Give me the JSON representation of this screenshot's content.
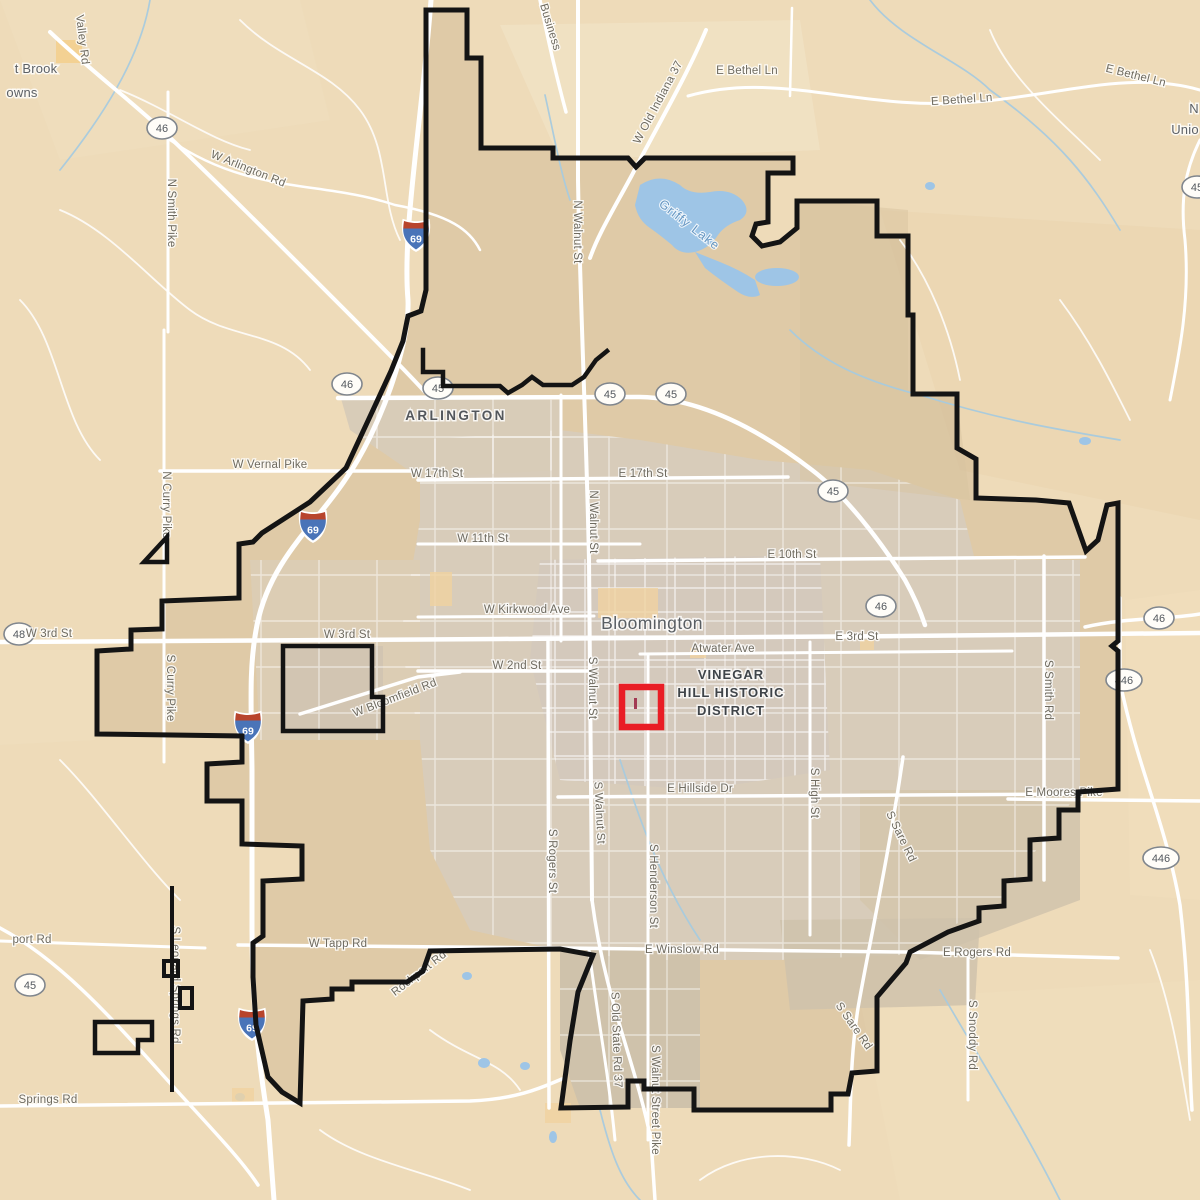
{
  "map": {
    "city_name": "Bloomington",
    "highlight_district": "VINEGAR HILL HISTORIC DISTRICT",
    "lake_name": "Griffy Lake",
    "colors": {
      "land": "#eedbb9",
      "urban": "#d6cabb",
      "inside_boundary": "#d9c5a5",
      "water": "#9ec5e6",
      "boundary": "#141414",
      "highlight_box": "#e91d25",
      "road": "#ffffff",
      "road_label": "#6e6a5f"
    },
    "labels": [
      {
        "text": "t Brook",
        "x": 36,
        "y": 73,
        "rot": 0,
        "cls": "town",
        "name": "town-label-clipped-brook"
      },
      {
        "text": "owns",
        "x": 22,
        "y": 97,
        "rot": 0,
        "cls": "town",
        "name": "town-label-clipped-owns"
      },
      {
        "text": "N",
        "x": 1194,
        "y": 113,
        "rot": 0,
        "cls": "town",
        "name": "town-label-clipped-n"
      },
      {
        "text": "Unio",
        "x": 1185,
        "y": 134,
        "rot": 0,
        "cls": "town",
        "name": "town-label-clipped-unionville"
      },
      {
        "text": "ARLINGTON",
        "x": 456,
        "y": 420,
        "rot": 0,
        "cls": "district",
        "name": "area-label-arlington"
      },
      {
        "text": "Bloomington",
        "x": 652,
        "y": 629,
        "rot": 0,
        "cls": "city",
        "name": "city-label-bloomington"
      },
      {
        "text": "VINEGAR",
        "x": 731,
        "y": 679,
        "rot": 0,
        "cls": "historic",
        "name": "district-label-line1"
      },
      {
        "text": "HILL HISTORIC",
        "x": 731,
        "y": 697,
        "rot": 0,
        "cls": "historic",
        "name": "district-label-line2"
      },
      {
        "text": "DISTRICT",
        "x": 731,
        "y": 715,
        "rot": 0,
        "cls": "historic",
        "name": "district-label-line3"
      },
      {
        "text": "Griffy Lake",
        "x": 687,
        "y": 228,
        "rot": 38,
        "cls": "water",
        "name": "lake-label-griffy"
      },
      {
        "text": "Valley Rd",
        "x": 79,
        "y": 40,
        "rot": 83,
        "cls": "road",
        "name": "road-label-valley-rd"
      },
      {
        "text": "W Arlington Rd",
        "x": 247,
        "y": 172,
        "rot": 22,
        "cls": "road",
        "name": "road-label-w-arlington-rd"
      },
      {
        "text": "N Smith Pike",
        "x": 168,
        "y": 213,
        "rot": 90,
        "cls": "road",
        "name": "road-label-n-smith-pike"
      },
      {
        "text": "Business",
        "x": 547,
        "y": 28,
        "rot": 73,
        "cls": "road",
        "name": "road-label-business"
      },
      {
        "text": "W Old Indiana 37",
        "x": 661,
        "y": 104,
        "rot": -62,
        "cls": "road",
        "name": "road-label-w-old-indiana-37"
      },
      {
        "text": "E Bethel Ln",
        "x": 747,
        "y": 74,
        "rot": 0,
        "cls": "road",
        "name": "road-label-e-bethel-ln-1"
      },
      {
        "text": "E Bethel Ln",
        "x": 962,
        "y": 103,
        "rot": -4,
        "cls": "road",
        "name": "road-label-e-bethel-ln-2"
      },
      {
        "text": "E Bethel Ln",
        "x": 1135,
        "y": 79,
        "rot": 14,
        "cls": "road",
        "name": "road-label-e-bethel-ln-3"
      },
      {
        "text": "N Walnut St",
        "x": 574,
        "y": 232,
        "rot": 90,
        "cls": "road",
        "name": "road-label-n-walnut-st-1"
      },
      {
        "text": "N Curry Pike",
        "x": 163,
        "y": 505,
        "rot": 90,
        "cls": "road",
        "name": "road-label-n-curry-pike"
      },
      {
        "text": "W Vernal Pike",
        "x": 270,
        "y": 468,
        "rot": 0,
        "cls": "road",
        "name": "road-label-w-vernal-pike"
      },
      {
        "text": "W 17th St",
        "x": 437,
        "y": 477,
        "rot": 0,
        "cls": "road",
        "name": "road-label-w-17th-st"
      },
      {
        "text": "E 17th St",
        "x": 643,
        "y": 477,
        "rot": 0,
        "cls": "road",
        "name": "road-label-e-17th-st"
      },
      {
        "text": "N Walnut St",
        "x": 590,
        "y": 522,
        "rot": 90,
        "cls": "road",
        "name": "road-label-n-walnut-st-2"
      },
      {
        "text": "W 11th St",
        "x": 483,
        "y": 542,
        "rot": 0,
        "cls": "road",
        "name": "road-label-w-11th-st"
      },
      {
        "text": "E 10th St",
        "x": 792,
        "y": 558,
        "rot": 0,
        "cls": "road",
        "name": "road-label-e-10th-st"
      },
      {
        "text": "W Kirkwood Ave",
        "x": 527,
        "y": 613,
        "rot": 0,
        "cls": "road",
        "name": "road-label-w-kirkwood-ave"
      },
      {
        "text": "W 3rd St",
        "x": 49,
        "y": 637,
        "rot": 0,
        "cls": "road",
        "name": "road-label-w-3rd-st-1"
      },
      {
        "text": "W 3rd St",
        "x": 347,
        "y": 638,
        "rot": 0,
        "cls": "road",
        "name": "road-label-w-3rd-st-2"
      },
      {
        "text": "E 3rd St",
        "x": 857,
        "y": 640,
        "rot": 0,
        "cls": "road",
        "name": "road-label-e-3rd-st"
      },
      {
        "text": "Atwater Ave",
        "x": 723,
        "y": 652,
        "rot": 0,
        "cls": "road",
        "name": "road-label-atwater-ave"
      },
      {
        "text": "W 2nd St",
        "x": 517,
        "y": 669,
        "rot": 0,
        "cls": "road",
        "name": "road-label-w-2nd-st"
      },
      {
        "text": "W Bloomfield Rd",
        "x": 396,
        "y": 701,
        "rot": -21,
        "cls": "road",
        "name": "road-label-w-bloomfield-rd"
      },
      {
        "text": "S Walnut St",
        "x": 589,
        "y": 688,
        "rot": 90,
        "cls": "road",
        "name": "road-label-s-walnut-st-1"
      },
      {
        "text": "S Curry Pike",
        "x": 167,
        "y": 688,
        "rot": 90,
        "cls": "road",
        "name": "road-label-s-curry-pike"
      },
      {
        "text": "E Hillside Dr",
        "x": 700,
        "y": 792,
        "rot": 0,
        "cls": "road",
        "name": "road-label-e-hillside-dr"
      },
      {
        "text": "S Walnut St",
        "x": 596,
        "y": 813,
        "rot": 87,
        "cls": "road",
        "name": "road-label-s-walnut-st-2"
      },
      {
        "text": "S High St",
        "x": 811,
        "y": 793,
        "rot": 90,
        "cls": "road",
        "name": "road-label-s-high-st"
      },
      {
        "text": "S Sare Rd",
        "x": 898,
        "y": 838,
        "rot": 64,
        "cls": "road",
        "name": "road-label-s-sare-rd-1"
      },
      {
        "text": "S Rogers St",
        "x": 549,
        "y": 861,
        "rot": 90,
        "cls": "road",
        "name": "road-label-s-rogers-st"
      },
      {
        "text": "S Henderson St",
        "x": 650,
        "y": 886,
        "rot": 90,
        "cls": "road",
        "name": "road-label-s-henderson-st"
      },
      {
        "text": "S Smith Rd",
        "x": 1045,
        "y": 690,
        "rot": 90,
        "cls": "road",
        "name": "road-label-s-smith-rd"
      },
      {
        "text": "E Moores Pike",
        "x": 1064,
        "y": 796,
        "rot": 0,
        "cls": "road",
        "name": "road-label-e-moores-pike"
      },
      {
        "text": "port Rd",
        "x": 32,
        "y": 943,
        "rot": 0,
        "cls": "road",
        "name": "road-label-clipped-airport-rd"
      },
      {
        "text": "W Tapp Rd",
        "x": 338,
        "y": 947,
        "rot": 0,
        "cls": "road",
        "name": "road-label-w-tapp-rd"
      },
      {
        "text": "E Winslow Rd",
        "x": 682,
        "y": 953,
        "rot": 0,
        "cls": "road",
        "name": "road-label-e-winslow-rd"
      },
      {
        "text": "E Rogers Rd",
        "x": 977,
        "y": 956,
        "rot": 0,
        "cls": "road",
        "name": "road-label-e-rogers-rd"
      },
      {
        "text": "Rockport Rd",
        "x": 421,
        "y": 976,
        "rot": -38,
        "cls": "road",
        "name": "road-label-rockport-rd"
      },
      {
        "text": "S Leonard Springs Rd",
        "x": 172,
        "y": 985,
        "rot": 90,
        "cls": "road",
        "name": "road-label-s-leonard-springs-rd"
      },
      {
        "text": "S Old State Rd 37",
        "x": 613,
        "y": 1040,
        "rot": 88,
        "cls": "road",
        "name": "road-label-s-old-state-rd-37"
      },
      {
        "text": "S Walnut Street Pike",
        "x": 652,
        "y": 1100,
        "rot": 90,
        "cls": "road",
        "name": "road-label-s-walnut-street-pike"
      },
      {
        "text": "S Snoddy Rd",
        "x": 969,
        "y": 1035,
        "rot": 90,
        "cls": "road",
        "name": "road-label-s-snoddy-rd"
      },
      {
        "text": "S Sare Rd",
        "x": 851,
        "y": 1028,
        "rot": 55,
        "cls": "road",
        "name": "road-label-s-sare-rd-2"
      },
      {
        "text": "Springs Rd",
        "x": 48,
        "y": 1103,
        "rot": 0,
        "cls": "road",
        "name": "road-label-clipped-springs-rd"
      }
    ],
    "route_shields": [
      {
        "text": "46",
        "x": 162,
        "y": 128
      },
      {
        "text": "46",
        "x": 347,
        "y": 384
      },
      {
        "text": "45",
        "x": 438,
        "y": 388
      },
      {
        "text": "45",
        "x": 610,
        "y": 394
      },
      {
        "text": "45",
        "x": 671,
        "y": 394
      },
      {
        "text": "45",
        "x": 833,
        "y": 491
      },
      {
        "text": "46",
        "x": 881,
        "y": 606
      },
      {
        "text": "46",
        "x": 1159,
        "y": 618
      },
      {
        "text": "446",
        "x": 1124,
        "y": 680
      },
      {
        "text": "446",
        "x": 1161,
        "y": 858
      },
      {
        "text": "48",
        "x": 19,
        "y": 634
      },
      {
        "text": "45",
        "x": 30,
        "y": 985
      },
      {
        "text": "45",
        "x": 1197,
        "y": 187
      }
    ],
    "interstate_shields": [
      {
        "text": "69",
        "x": 416,
        "y": 236
      },
      {
        "text": "69",
        "x": 313,
        "y": 527
      },
      {
        "text": "69",
        "x": 248,
        "y": 728
      },
      {
        "text": "69",
        "x": 252,
        "y": 1025
      }
    ]
  }
}
